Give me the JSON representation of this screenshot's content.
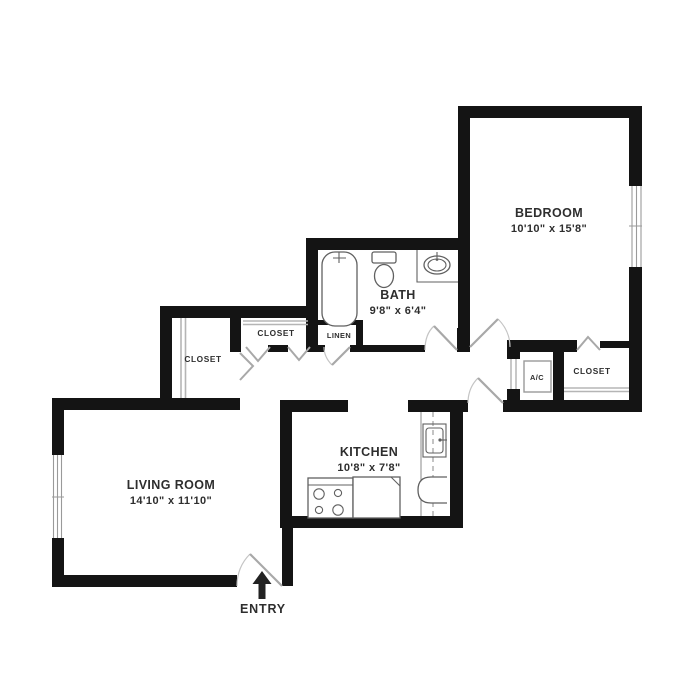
{
  "plan": {
    "bedroom": {
      "label": "BEDROOM",
      "dims": "10'10\" x 15'8\""
    },
    "bath": {
      "label": "BATH",
      "dims": "9'8\" x 6'4\""
    },
    "kitchen": {
      "label": "KITCHEN",
      "dims": "10'8\" x 7'8\""
    },
    "living_room": {
      "label": "LIVING ROOM",
      "dims": "14'10\" x 11'10\""
    },
    "closet_left": {
      "label": "CLOSET"
    },
    "closet_hall": {
      "label": "CLOSET"
    },
    "closet_bedroom": {
      "label": "CLOSET"
    },
    "linen": {
      "label": "LINEN"
    },
    "ac": {
      "label": "A/C"
    },
    "entry": {
      "label": "ENTRY"
    }
  },
  "colors": {
    "wall": "#141414",
    "door": "#a8a8a8",
    "fixture": "#606060",
    "shelf": "#b5b5b5",
    "text": "#2e2e2e",
    "background": "#ffffff"
  }
}
